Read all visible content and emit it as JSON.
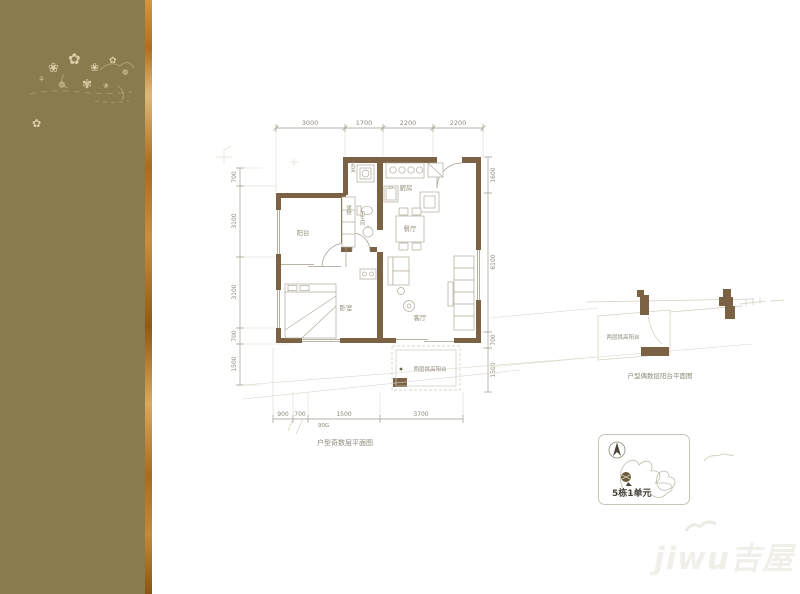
{
  "sidebar": {
    "flowers": [
      "❀",
      "✿",
      "❀",
      "✿",
      "❁",
      "❁",
      "✾",
      "⚘",
      "❀",
      "✿"
    ]
  },
  "plan": {
    "captions": {
      "main": "户型奇数层平面图",
      "side": "户型偶数层阳台平面图"
    },
    "rooms": {
      "balcony": "阳台",
      "bedroom": "卧室",
      "entry": "玄关",
      "bath": "卫生间",
      "storage": "储物",
      "kitchen": "厨房",
      "dining": "餐厅",
      "living": "客厅",
      "tall_balcony_main": "两层挑高阳台",
      "tall_balcony_side": "两层挑高阳台"
    },
    "dims": {
      "top": [
        "3000",
        "1700",
        "2200",
        "2200"
      ],
      "left": [
        "700",
        "3100",
        "3100",
        "700",
        "1500"
      ],
      "right": [
        "1600",
        "6100",
        "700",
        "1500"
      ],
      "bottom": [
        "900",
        "700",
        "1500",
        "3700"
      ],
      "note": "90G"
    }
  },
  "keyplan": {
    "label": "5栋1单元"
  },
  "watermark": {
    "latin": "jiwu",
    "cn": "吉屋"
  },
  "colors": {
    "sidebar": "#8a7b4f",
    "stripe": "#b97a28",
    "wall": "#7b6245",
    "thin_line": "#a39b8b",
    "faint_line": "#d6cfc0",
    "dim_text": "#8f897b"
  }
}
